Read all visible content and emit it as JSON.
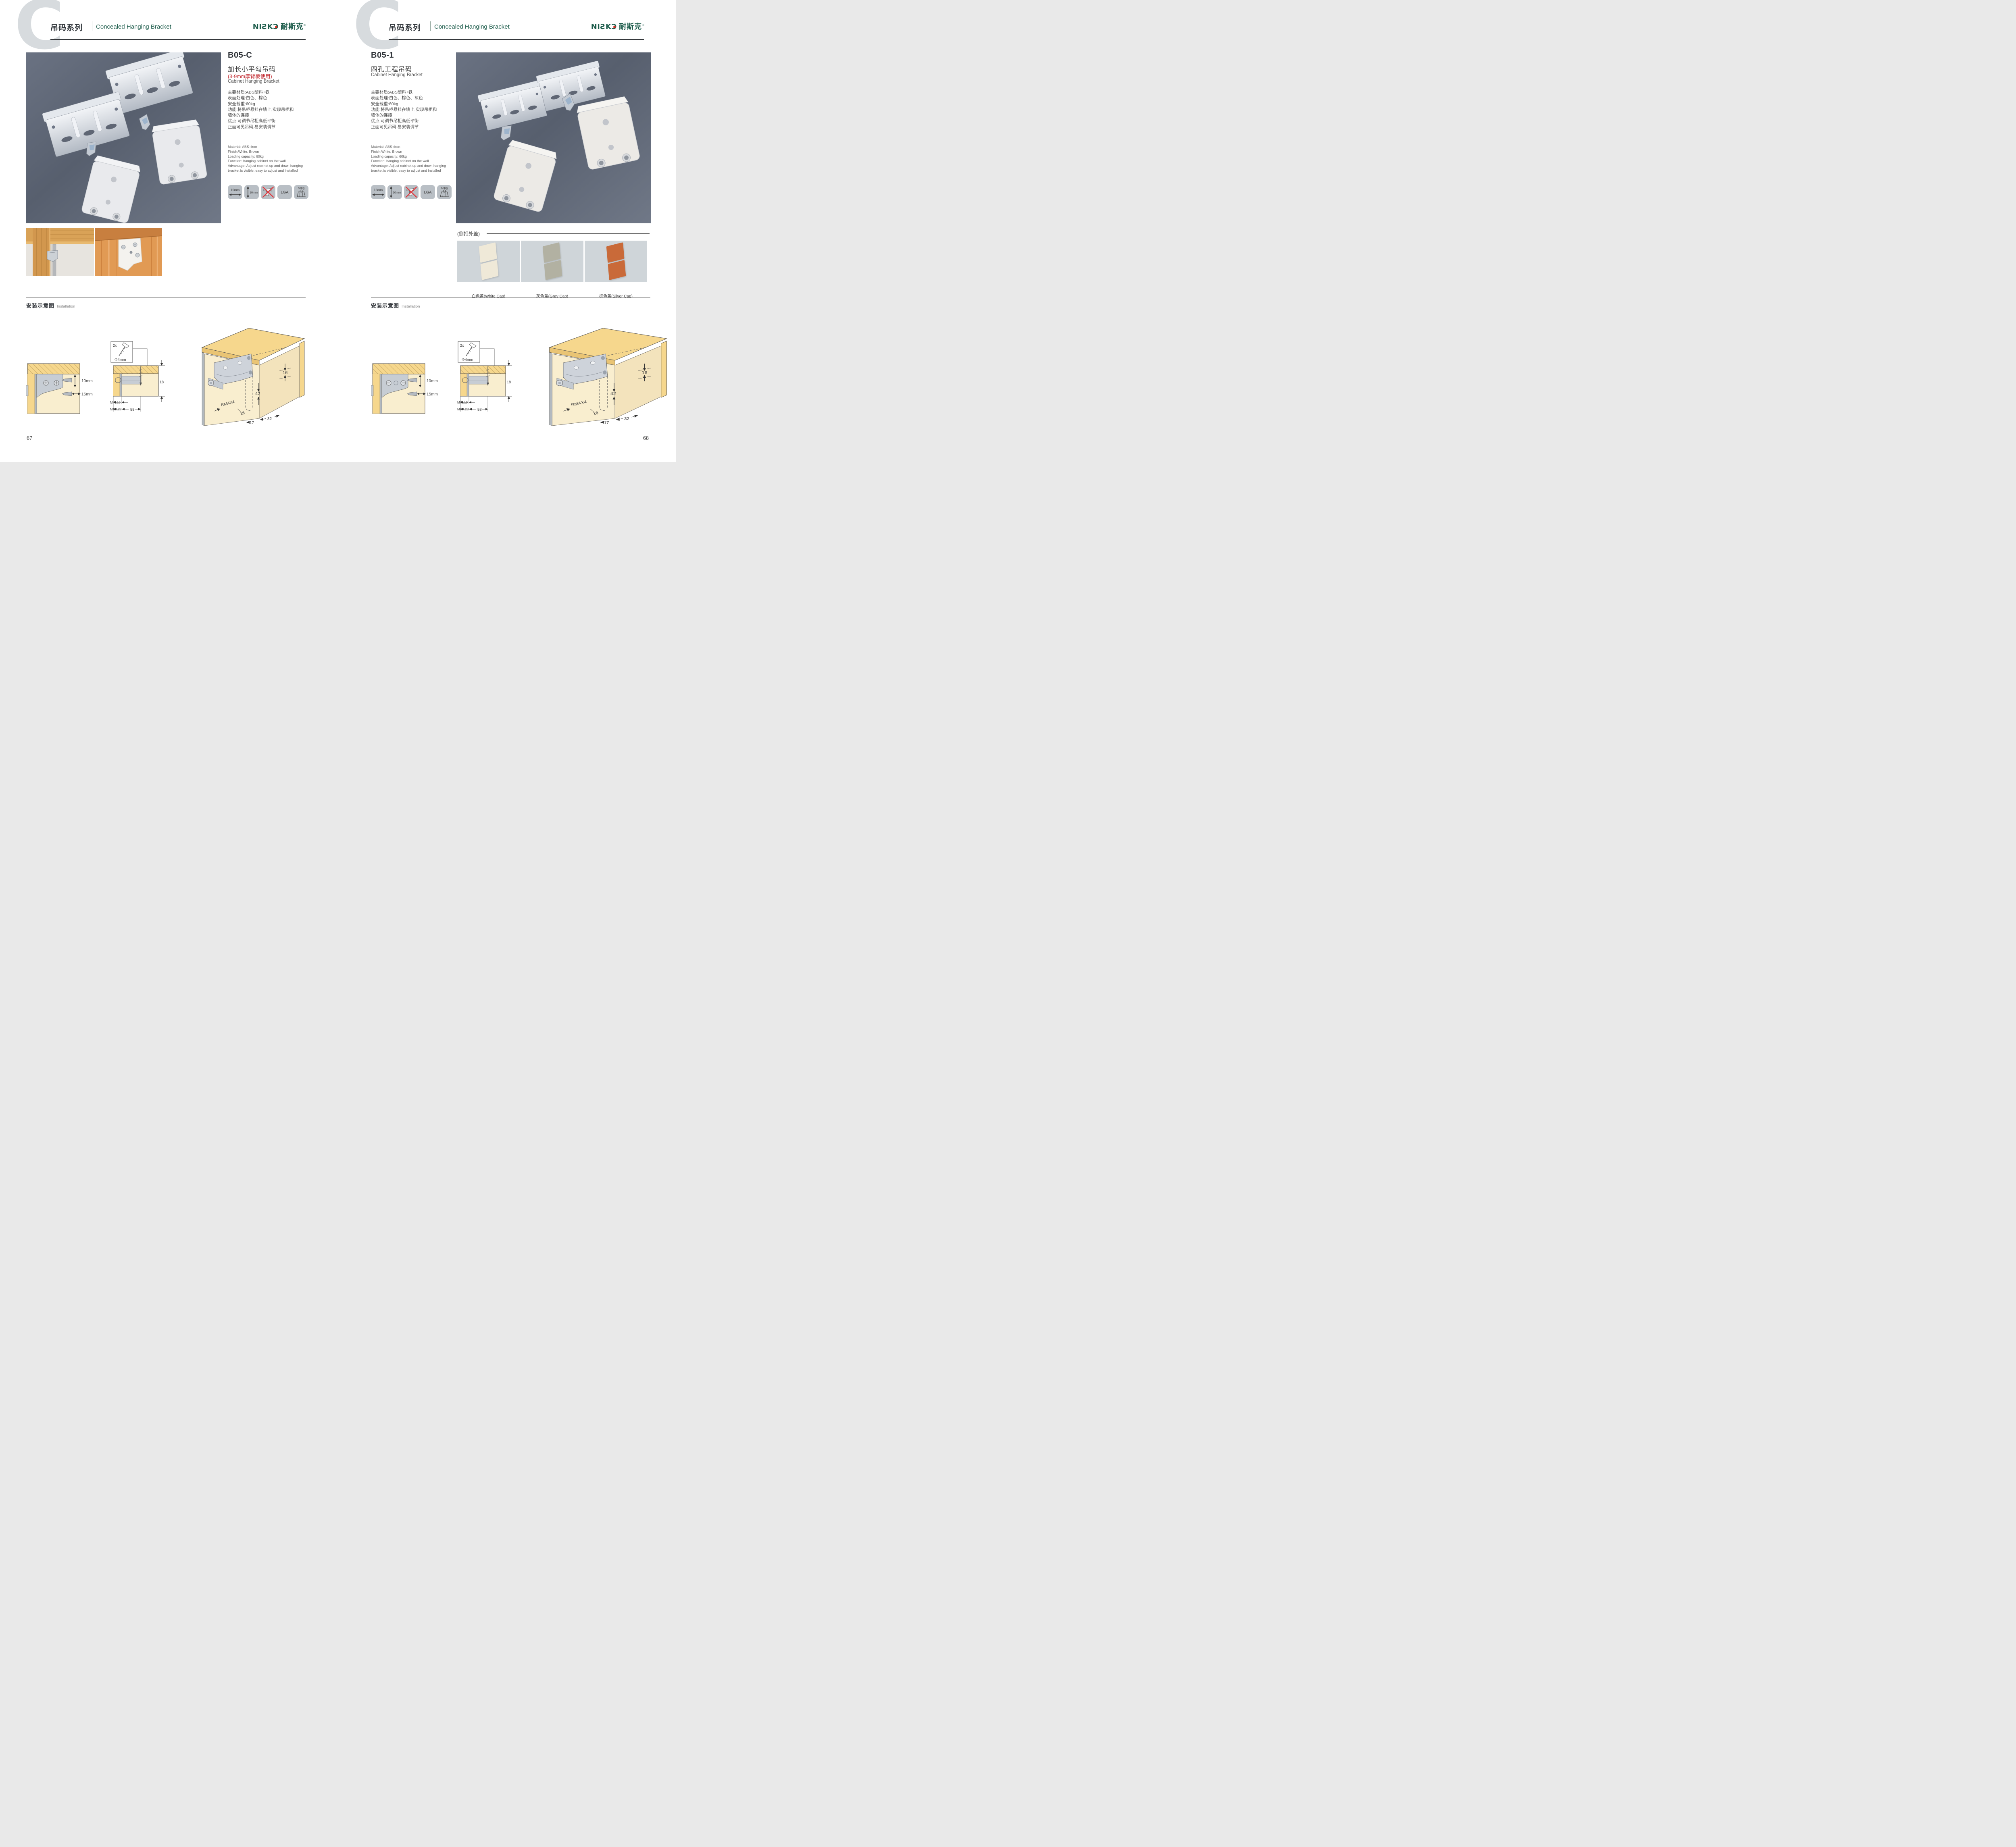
{
  "header": {
    "letter": "C",
    "series_cn": "吊码系列",
    "series_en": "Concealed Hanging Bracket",
    "logo_latin": "NIƧK",
    "logo_o": "Ɔ",
    "logo_cn": "耐斯克",
    "logo_reg": "®",
    "accent_green": "#1d5c4b"
  },
  "install": {
    "title_cn": "安装示意图",
    "title_en": "Installation"
  },
  "icons": {
    "i1": "15mm",
    "i2": "10mm",
    "i3": "no-electric-drill",
    "i4": "LGA",
    "i5": "60Kg"
  },
  "page1": {
    "code": "B05-C",
    "name_cn": "加长小平勾吊码",
    "note": "(3-9mm厚背板使用)",
    "note_color": "#c1272d",
    "name_en": "Cabinet Hanging Bracket",
    "specs_cn": [
      "主要材质:ABS塑料+铁",
      "表面处理:白色、棕色",
      "安全载重:60kg",
      "功能:将吊柜悬挂在墙上,实现吊柜和",
      "墙体的连接",
      "优点:可调节吊柜高低平衡",
      "正面可见吊码,易安装调节"
    ],
    "specs_en": [
      "Material: ABS+Iron",
      "Finish:White, Brown",
      "Loading capacity: 60kg",
      "Function: hanging cabinet on the wall",
      "Advantage: Adjust cabinet up and down hanging",
      "bracket is visible, easy to adjust and installed"
    ],
    "page_no": "67",
    "d1": {
      "v": "10mm",
      "h": "15mm"
    },
    "d2": {
      "count": "2x",
      "dia": "Φ4mm",
      "t": "18",
      "min": "MIN.15",
      "max": "MAX.28",
      "span": "58"
    },
    "d3": {
      "top": "16",
      "mid": "42",
      "r": "RMAX4",
      "low": "16",
      "b1": "17",
      "b2": "32"
    }
  },
  "page2": {
    "code": "B05-1",
    "name_cn": "四孔工程吊码",
    "name_en": "Cabinet Hanging Bracket",
    "specs_cn": [
      "主要材质:ABS塑料+铁",
      "表面处理:白色、棕色、灰色",
      "安全载重:60kg",
      "功能:将吊柜悬挂在墙上,实现吊柜和",
      "墙体的连接",
      "优点:可调节吊柜高低平衡",
      "正面可见吊码,易安装调节"
    ],
    "specs_en": [
      "Material: ABS+Iron",
      "Finish:White, Brown",
      "Loading capacity: 60kg",
      "Function: hanging cabinet on the wall",
      "Advantage: Adjust cabinet up and down hanging",
      "bracket is visible, easy to adjust and installed"
    ],
    "caps": {
      "title": "(侧扣外盖)",
      "items": [
        {
          "label": "白色盖(White Cap)",
          "color": "#efe9d8"
        },
        {
          "label": "灰色盖(Gray Cap)",
          "color": "#b2b1a2"
        },
        {
          "label": "棕色盖(Silver Cap)",
          "color": "#c96a39"
        }
      ]
    },
    "page_no": "68",
    "d1": {
      "v": "10mm",
      "h": "15mm"
    },
    "d2": {
      "count": "2x",
      "dia": "Φ4mm",
      "t": "18",
      "min": "MIN.10",
      "max": "MAX.23",
      "span": "58"
    },
    "d3": {
      "top": "16",
      "mid": "42",
      "r": "RMAX4",
      "low": "16",
      "b1": "17",
      "b2": "32"
    }
  }
}
